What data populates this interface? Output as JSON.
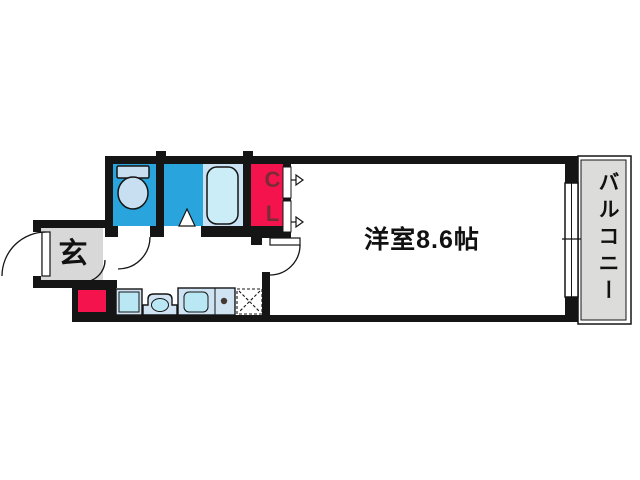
{
  "labels": {
    "entrance": "玄",
    "main_room": "洋室8.6帖",
    "closet": "CL",
    "balcony": "バルコニー"
  },
  "colors": {
    "wall": "#151515",
    "wet_area_blue": "#2aa4dc",
    "fixture_light_blue": "#c8dff2",
    "bathtub_area_blue": "#c9e3f4",
    "bathtub_fill": "#cbedf8",
    "closet_red": "#f5134d",
    "closet_letters": "#7b2b38",
    "entrance_gray": "#d8d8d8",
    "balcony_gray": "#dcdcda",
    "kitchen_counter_blue": "#cfe3f2",
    "kitchen_inner_blue": "#b9e7f4",
    "stove_dot": "#443830",
    "text": "#111111"
  },
  "fixtures": [
    "toilet-icon",
    "bathtub-icon",
    "bath-folding-door-icon",
    "washing-machine-pan-icon",
    "washbasin-icon",
    "kitchen-sink-icon",
    "stove-space-icon",
    "door-swing-arc-icon",
    "closet-door-arrow-icon",
    "sliding-window-icon"
  ]
}
